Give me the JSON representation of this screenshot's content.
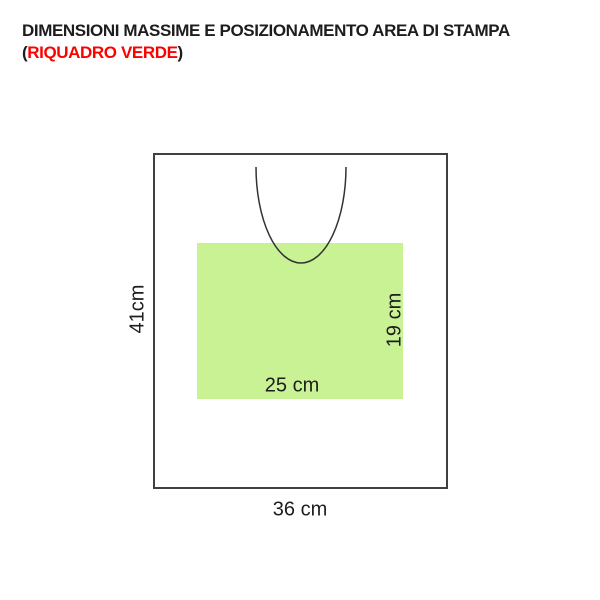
{
  "title": {
    "line1": "DIMENSIONI MASSIME E POSIZIONAMENTO AREA DI STAMPA",
    "paren_open": "(",
    "highlight": "RIQUADRO VERDE",
    "paren_close": ")"
  },
  "colors": {
    "title_text": "#1d1d1d",
    "highlight_red": "#fe0000",
    "print_area_green": "#c9f295",
    "outline_gray": "#404040",
    "curve_stroke": "#333333"
  },
  "diagram": {
    "bag_width_label": "36 cm",
    "bag_height_label": "41cm",
    "print_width_label": "25 cm",
    "print_height_label": "19 cm"
  }
}
